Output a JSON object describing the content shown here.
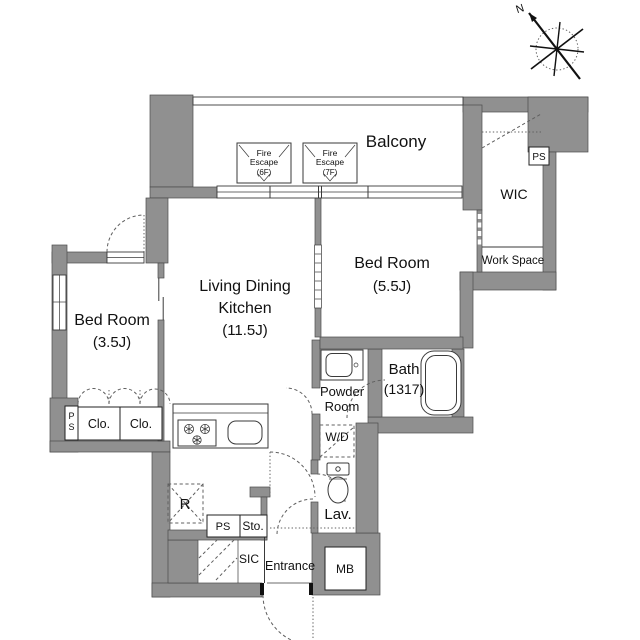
{
  "title": "Apartment floor plan",
  "compass": {
    "north_label": "N"
  },
  "rooms": {
    "balcony": "Balcony",
    "wic": "WIC",
    "work_space": "Work Space",
    "bedroom_55": {
      "name": "Bed Room",
      "size": "(5.5J)"
    },
    "ldk": {
      "line1": "Living Dining",
      "line2": "Kitchen",
      "size": "(11.5J)"
    },
    "bedroom_35": {
      "name": "Bed Room",
      "size": "(3.5J)"
    },
    "bath": {
      "name": "Bath",
      "size": "(1317)"
    },
    "powder_room": {
      "line1": "Powder",
      "line2": "Room"
    },
    "washer_dryer": "W/D",
    "lavatory": "Lav.",
    "entrance": "Entrance",
    "shoes_closet": "SIC",
    "storage": "Sto.",
    "meter_box": "MB",
    "refrigerator": "R",
    "closet_1": "Clo.",
    "closet_2": "Clo."
  },
  "pipe_spaces": {
    "top_right": "PS",
    "hall": "PS",
    "left_p": "P",
    "left_s": "S"
  },
  "fire_escape_hatches": [
    {
      "line1": "Fire",
      "line2": "Escape",
      "floor": "(6F)"
    },
    {
      "line1": "Fire",
      "line2": "Escape",
      "floor": "(7F)"
    }
  ],
  "colors": {
    "wall": "#909090",
    "wall_edge": "#4a4a4a",
    "line": "#3a3a3a",
    "dash": "#606060",
    "text": "#111111",
    "bg": "#ffffff"
  }
}
